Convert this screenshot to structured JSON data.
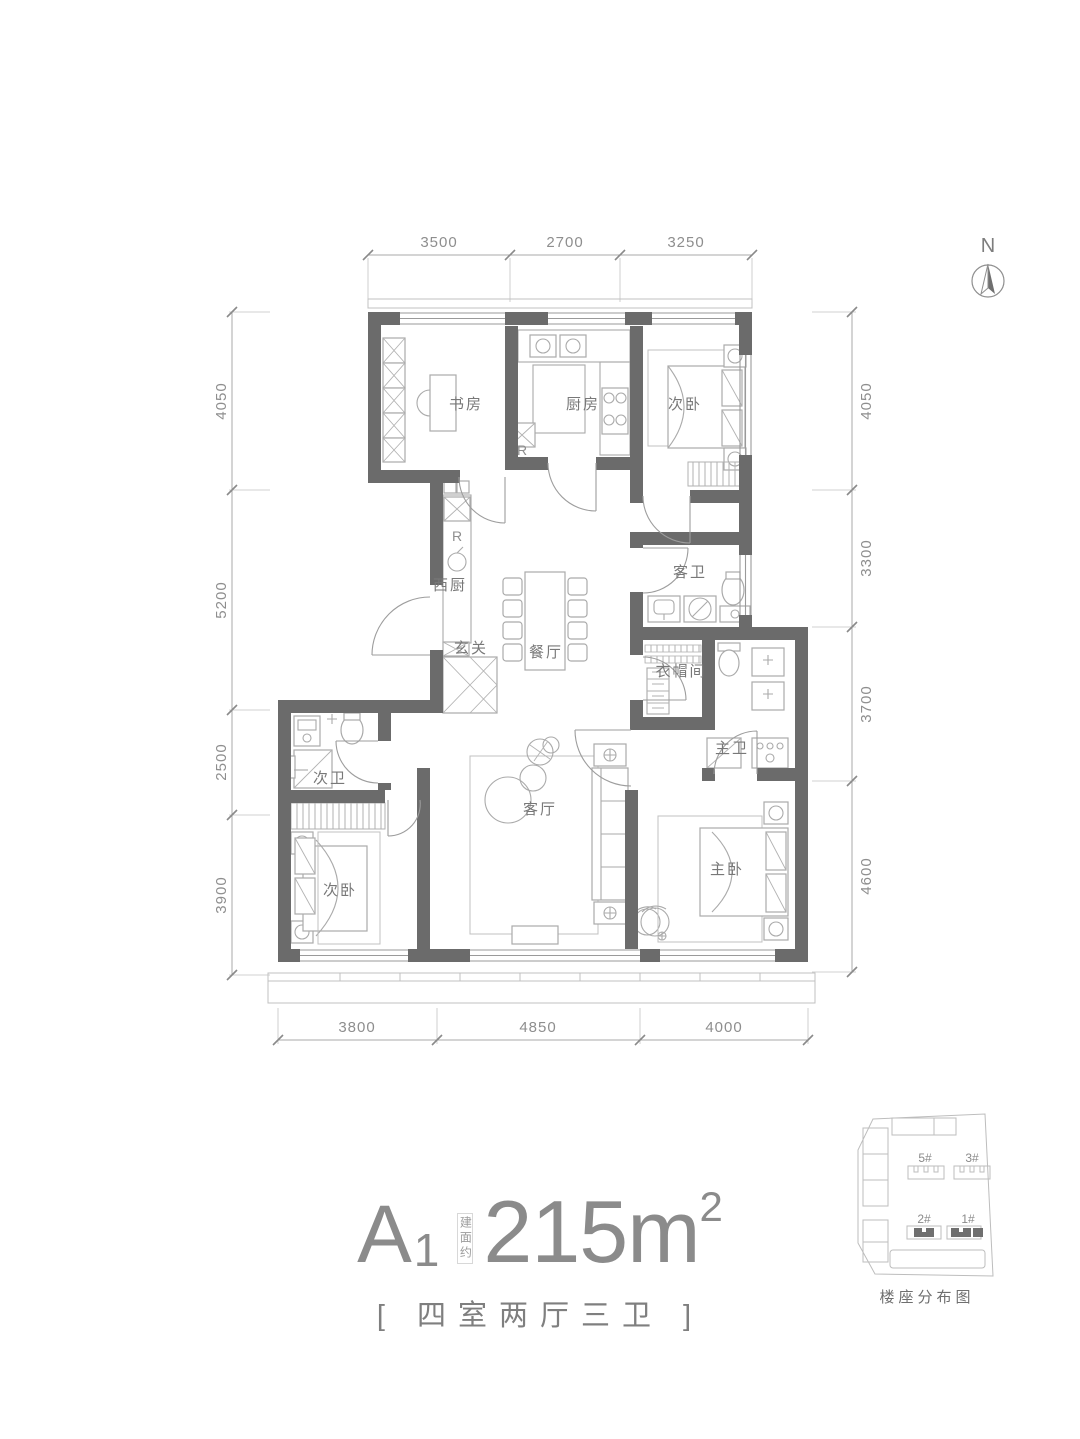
{
  "north": {
    "label": "N"
  },
  "dims": {
    "top": [
      "3500",
      "2700",
      "3250"
    ],
    "bottom": [
      "3800",
      "4850",
      "4000"
    ],
    "left": [
      "4050",
      "5200",
      "2500",
      "3900"
    ],
    "right": [
      "4050",
      "3300",
      "3700",
      "4600"
    ]
  },
  "rooms": {
    "study": "书房",
    "kitchen": "厨房",
    "bedroom_top": "次卧",
    "west_kitchen": "西厨",
    "foyer": "玄关",
    "dining": "餐厅",
    "guest_bath": "客卫",
    "cloakroom": "衣帽间",
    "master_bath": "主卫",
    "second_bath": "次卫",
    "bedroom_left": "次卧",
    "living": "客厅",
    "master_bedroom": "主卧"
  },
  "appliances": {
    "fridge": "R"
  },
  "title": {
    "unit": "A",
    "unit_sub": "1",
    "area_note": "建面约",
    "area": "215m",
    "area_sup": "2",
    "subtitle": "[ 四室两厅三卫 ]"
  },
  "siteplan": {
    "b5": "5#",
    "b3": "3#",
    "b2": "2#",
    "b1": "1#",
    "caption": "楼座分布图"
  },
  "colors": {
    "wall": "#6b6b6b",
    "furniture_line": "#aaaaaa",
    "dimension_text": "#8e8e8e",
    "room_text": "#787878",
    "title_text": "#8b8b8b"
  }
}
